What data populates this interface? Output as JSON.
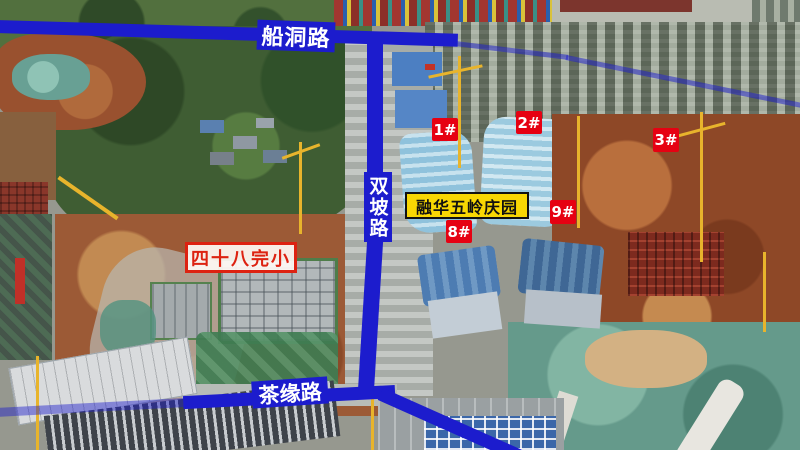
{
  "image": {
    "type": "aerial-construction-photo",
    "description": "Drone aerial photo of a residential construction project with annotated roads and building numbers"
  },
  "roads": {
    "top": {
      "name": "船洞路"
    },
    "vertical": {
      "name": "双坡路"
    },
    "bottom": {
      "name": "茶缘路"
    }
  },
  "project": {
    "name": "融华五岭庆园"
  },
  "school": {
    "name": "四十八完小"
  },
  "buildings": [
    {
      "label": "1#"
    },
    {
      "label": "2#"
    },
    {
      "label": "3#"
    },
    {
      "label": "9#"
    },
    {
      "label": "8#"
    }
  ],
  "colors": {
    "road_line": "#1c1ccd",
    "road_label_text": "#ffffff",
    "badge_red": "#e60112",
    "badge_text": "#ffffff",
    "banner_yellow": "#f8d703",
    "banner_text": "#111111",
    "school_red": "#dd2211",
    "school_bg": "#fffaf5"
  }
}
